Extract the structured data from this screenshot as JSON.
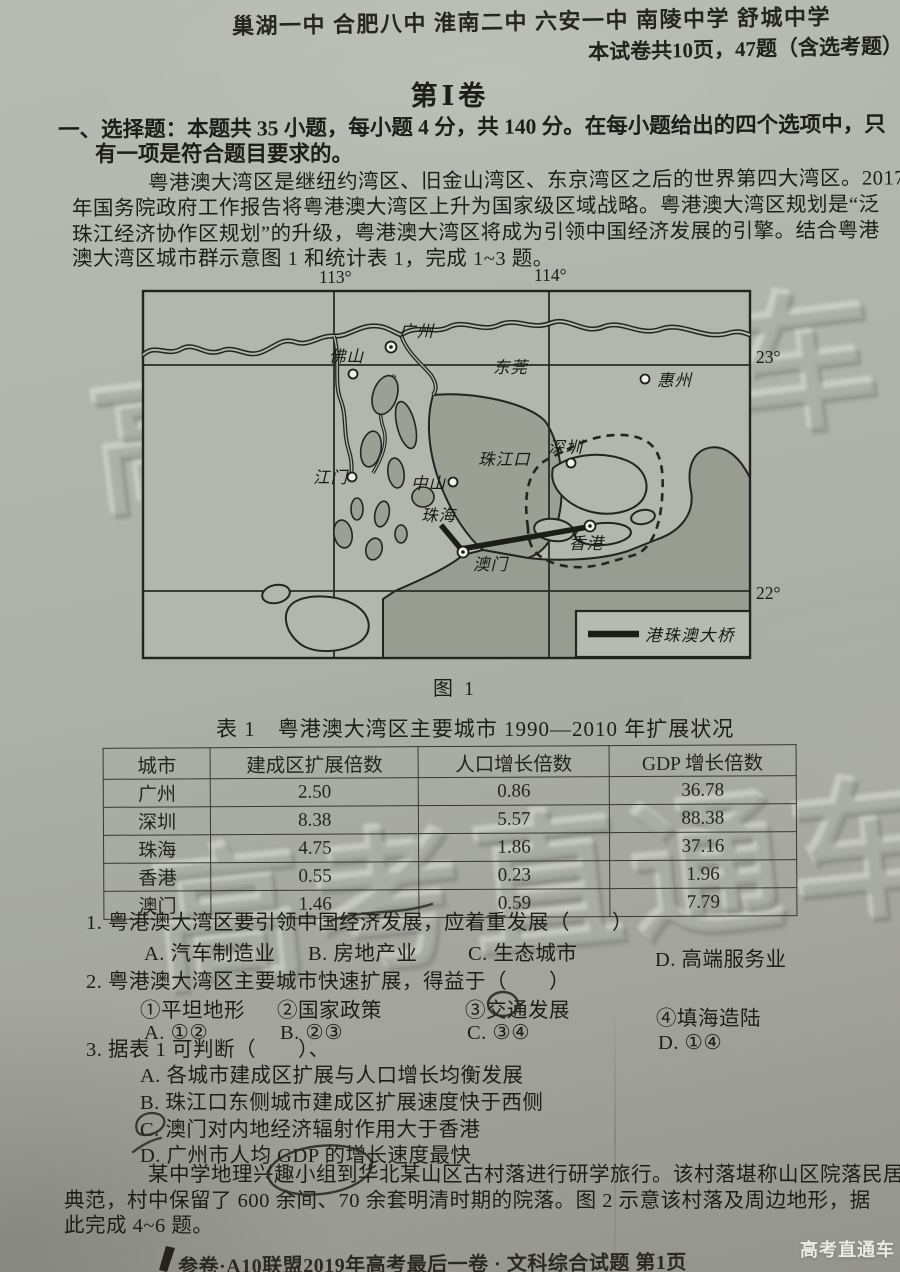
{
  "header": {
    "schools": "巢湖一中 合肥八中 淮南二中 六安一中 南陵中学 舒城中学",
    "paper_info": "本试卷共10页，47题（含选考题）"
  },
  "volume_title": "第Ⅰ卷",
  "section": {
    "line1": "一、选择题：本题共 35 小题，每小题 4 分，共 140 分。在每小题给出的四个选项中，只",
    "line2": "有一项是符合题目要求的。"
  },
  "intro": {
    "line1": "粤港澳大湾区是继纽约湾区、旧金山湾区、东京湾区之后的世界第四大湾区。2017",
    "line2": "年国务院政府工作报告将粤港澳大湾区上升为国家级区域战略。粤港澳大湾区规划是“泛",
    "line3": "珠江经济协作区规划”的升级，粤港澳大湾区将成为引领中国经济发展的引擎。结合粤港",
    "line4": "澳大湾区城市群示意图 1 和统计表 1，完成 1~3 题。"
  },
  "map": {
    "lon_113": "113°",
    "lon_114": "114°",
    "lat_23": "23°",
    "lat_22": "22°",
    "cities": {
      "foshan": "佛山",
      "guangzhou": "广州",
      "dongguan": "东莞",
      "huizhou": "惠州",
      "shenzhen": "深圳",
      "zhongshan": "中山",
      "jiangmen": "江门",
      "zhuhai": "珠海",
      "macau": "澳门",
      "hongkong": "香港"
    },
    "estuary": "珠江口",
    "legend": "港珠澳大桥",
    "caption": "图 1"
  },
  "table": {
    "title": "表 1　粤港澳大湾区主要城市 1990—2010 年扩展状况",
    "headers": [
      "城市",
      "建成区扩展倍数",
      "人口增长倍数",
      "GDP 增长倍数"
    ],
    "rows": [
      {
        "city": "广州",
        "built": "2.50",
        "pop": "0.86",
        "gdp": "36.78"
      },
      {
        "city": "深圳",
        "built": "8.38",
        "pop": "5.57",
        "gdp": "88.38"
      },
      {
        "city": "珠海",
        "built": "4.75",
        "pop": "1.86",
        "gdp": "37.16"
      },
      {
        "city": "香港",
        "built": "0.55",
        "pop": "0.23",
        "gdp": "1.96"
      },
      {
        "city": "澳门",
        "built": "1.46",
        "pop": "0.59",
        "gdp": "7.79"
      }
    ]
  },
  "q1": {
    "num": "1.",
    "stem": "粤港澳大湾区要引领中国经济发展，应着重发展（　　）",
    "a": "A. 汽车制造业",
    "b": "B. 房地产业",
    "c": "C. 生态城市",
    "d": "D. 高端服务业"
  },
  "q2": {
    "num": "2.",
    "stem": "粤港澳大湾区主要城市快速扩展，得益于（　　）",
    "i1": "①平坦地形",
    "i2": "②国家政策",
    "i3": "③交通发展",
    "i4": "④填海造陆",
    "a": "A. ①②",
    "b": "B. ②③",
    "c": "C. ③④",
    "d": "D. ①④"
  },
  "q3": {
    "num": "3.",
    "stem": "据表 1 可判断（　　）、",
    "a": "A. 各城市建成区扩展与人口增长均衡发展",
    "b": "B. 珠江口东侧城市建成区扩展速度快于西侧",
    "c": "C. 澳门对内地经济辐射作用大于香港",
    "d": "D. 广州市人均 GDP 的增长速度最快"
  },
  "closing": {
    "line1": "某中学地理兴趣小组到华北某山区古村落进行研学旅行。该村落堪称山区院落民居的",
    "line2": "典范，村中保留了 600 余间、70 余套明清时期的院落。图 2 示意该村落及周边地形，据",
    "line3": "此完成 4~6 题。"
  },
  "footer": {
    "brand": "高考直通车",
    "exam_line": "参卷·A10联盟2019年高考最后一卷 · 文科综合试题 第1页"
  },
  "watermark_text": "高考直通车"
}
